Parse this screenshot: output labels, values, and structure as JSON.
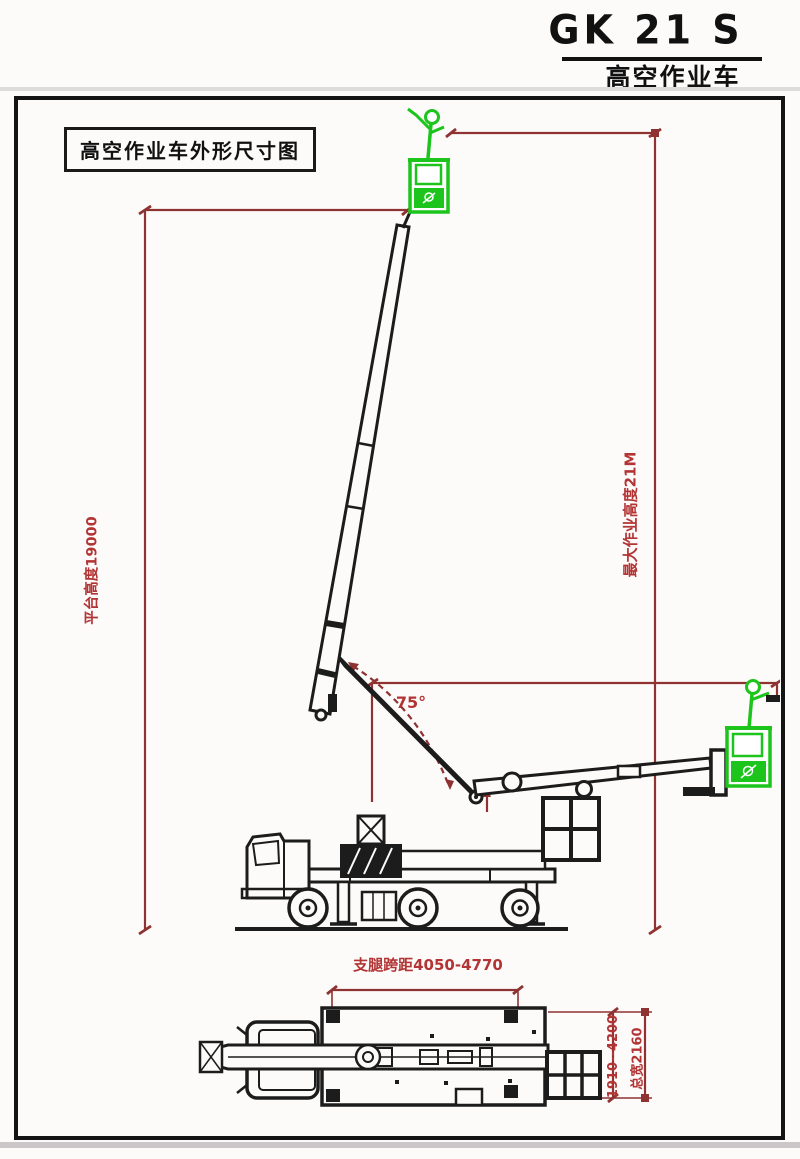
{
  "header": {
    "model": "GK 21 S",
    "subtitle": "高空作业车"
  },
  "drawing": {
    "title": "高空作业车外形尺寸图"
  },
  "side_view": {
    "platform_height": "平台高度19000",
    "max_working_height": "最大作业高度21M",
    "boom_angle": "75°"
  },
  "plan_view": {
    "outrigger_span": "支腿跨距4050-4770",
    "outrigger_width_range": "1910--4200",
    "overall_width": "总宽2160"
  },
  "colors": {
    "dimension_line_red": "#8f3232",
    "dimension_text_red": "#b23434",
    "basket_green": "#1cc41c",
    "drawing_black": "#1c1c1c"
  }
}
